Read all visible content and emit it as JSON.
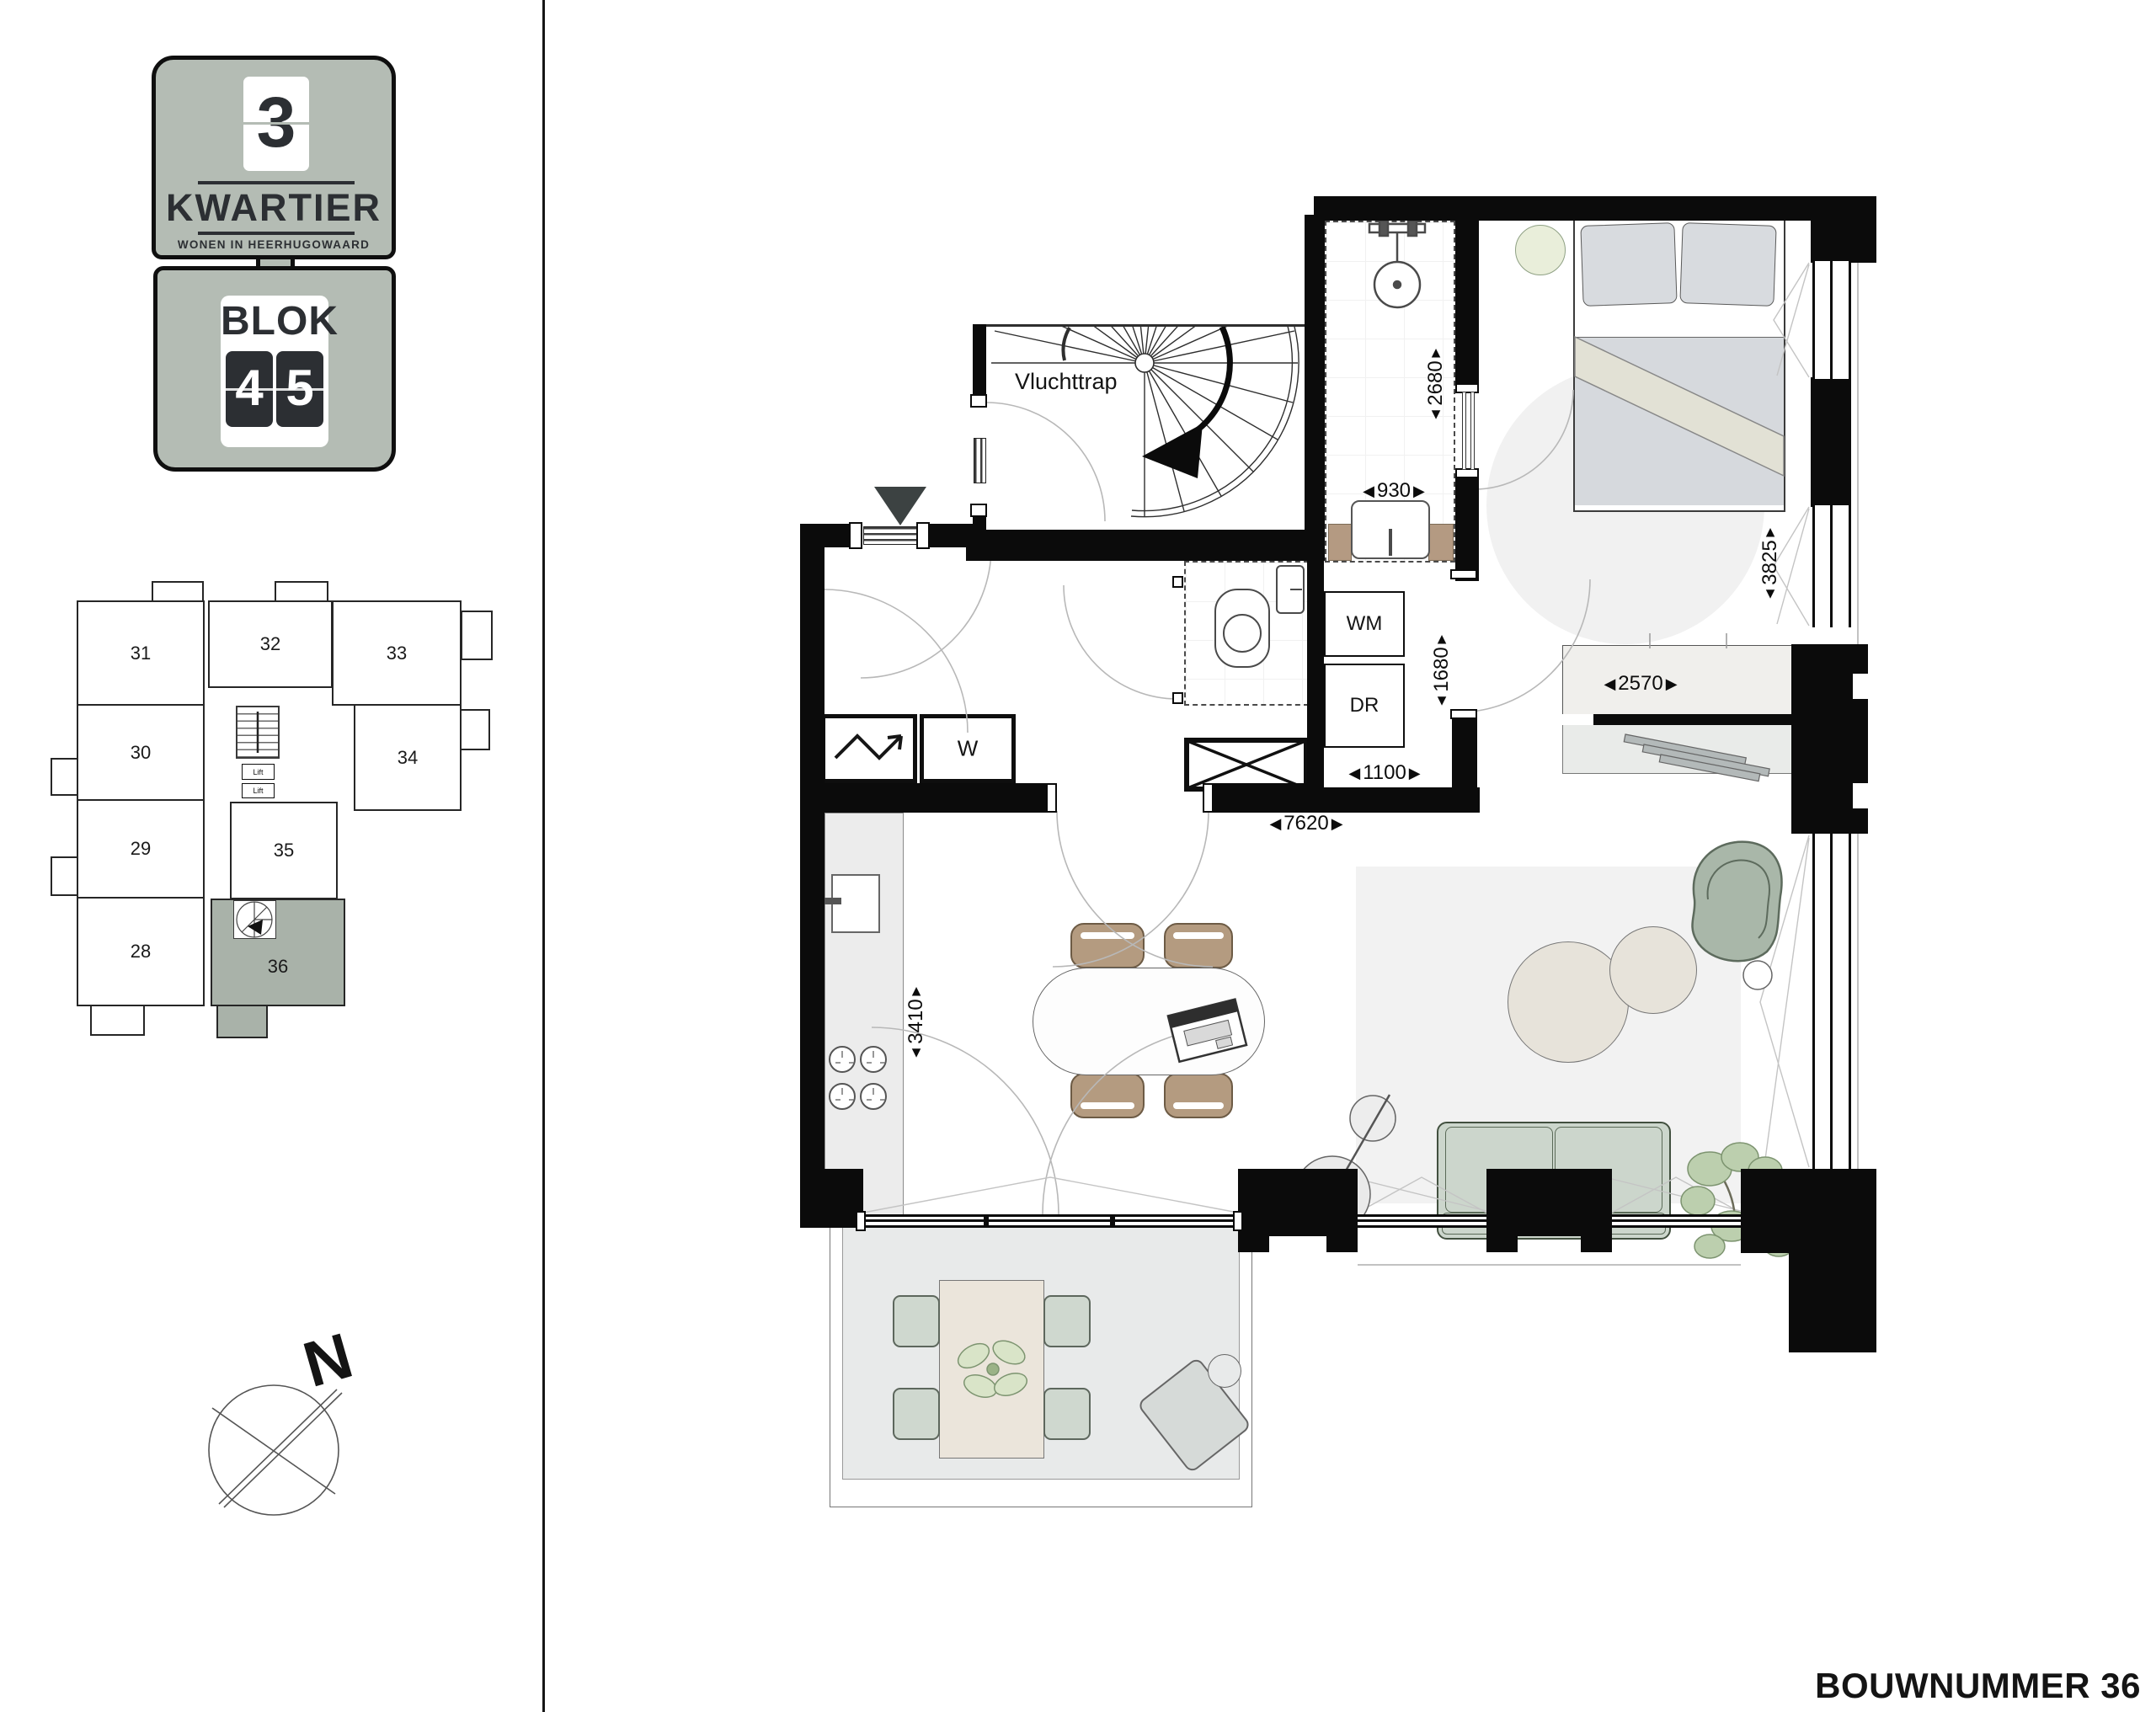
{
  "header": {
    "bouwnummer": "BOUWNUMMER 36"
  },
  "logo": {
    "number": "3",
    "name": "KWARTIER",
    "tagline": "WONEN IN HEERHUGOWAARD",
    "block_word": "BLOK",
    "block_digit_1": "4",
    "block_digit_2": "5"
  },
  "site_plan": {
    "units": [
      {
        "number": "31"
      },
      {
        "number": "32"
      },
      {
        "number": "33"
      },
      {
        "number": "30"
      },
      {
        "number": "34"
      },
      {
        "number": "29"
      },
      {
        "number": "35"
      },
      {
        "number": "28"
      },
      {
        "number": "36"
      }
    ],
    "lift_1": "Lift",
    "lift_2": "Lift"
  },
  "compass": {
    "north": "N"
  },
  "floor_plan": {
    "rooms": {
      "escape_stair": "Vluchttrap",
      "washing_machine": "WM",
      "dryer": "DR",
      "wardrobe": "W"
    },
    "dimensions": {
      "bath_width": "930",
      "bath_length": "2680",
      "bedroom_length": "3825",
      "closet_width": "2570",
      "utility_length": "1680",
      "utility_width": "1100",
      "apartment_width": "7620",
      "kitchen_length": "3410"
    }
  },
  "icons": {
    "tri_left": "◀",
    "tri_right": "▶",
    "tri_up": "▲",
    "tri_down": "▼"
  },
  "colors": {
    "badge": "#b4bcb4",
    "unit_highlight": "#a9b2a9",
    "wall": "#0b0b0b",
    "sofa": "#ccd6cc",
    "dining_chair": "#b49b80",
    "lounge_chair": "#a9b7a9",
    "plant": "#b9cdae",
    "vanity_wood": "#b49a82"
  }
}
